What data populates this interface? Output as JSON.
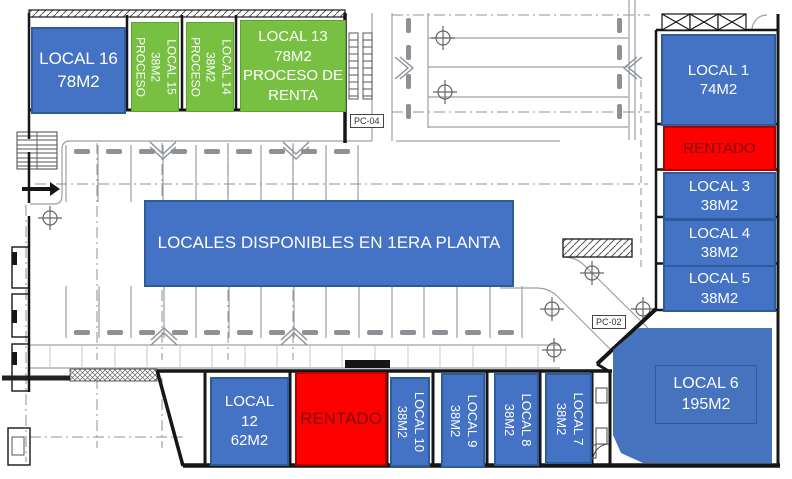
{
  "plan": {
    "banner": "LOCALES DISPONIBLES EN 1ERA PLANTA",
    "labels": {
      "pc04": "PC-04",
      "pc02": "PC-02"
    },
    "colors": {
      "available": "#4472C4",
      "in_process": "#77C042",
      "rented": "#FF0000",
      "rented_text": "#7A0C0C",
      "unit_text": "#FFFFFF",
      "border_blue": "#2E5B9C",
      "border_green": "#5FA433"
    },
    "units": {
      "local16": {
        "name": "LOCAL 16",
        "area": "78M2",
        "status": "available"
      },
      "local15": {
        "name": "LOCAL 15",
        "area": "38M2",
        "note": "PROCESO",
        "status": "in_process"
      },
      "local14": {
        "name": "LOCAL 14",
        "area": "38M2",
        "note": "PROCESO",
        "status": "in_process"
      },
      "local13": {
        "name": "LOCAL 13",
        "area": "78M2",
        "note1": "PROCESO DE",
        "note2": "RENTA",
        "status": "in_process"
      },
      "local1": {
        "name": "LOCAL 1",
        "area": "74M2",
        "status": "available"
      },
      "rentado_top": {
        "label": "RENTADO",
        "status": "rented"
      },
      "local3": {
        "name": "LOCAL 3",
        "area": "38M2",
        "status": "available"
      },
      "local4": {
        "name": "LOCAL 4",
        "area": "38M2",
        "status": "available"
      },
      "local5": {
        "name": "LOCAL 5",
        "area": "38M2",
        "status": "available"
      },
      "local6": {
        "name": "LOCAL 6",
        "area": "195M2",
        "status": "available"
      },
      "local12": {
        "name_line1": "LOCAL",
        "name_line2": "12",
        "area": "62M2",
        "status": "available"
      },
      "rentado_bottom": {
        "label": "RENTADO",
        "status": "rented"
      },
      "local10": {
        "name": "LOCAL 10",
        "area": "38M2",
        "status": "available"
      },
      "local9": {
        "name": "LOCAL 9",
        "area": "38M2",
        "status": "available"
      },
      "local8": {
        "name": "LOCAL 8",
        "area": "38M2",
        "status": "available"
      },
      "local7": {
        "name": "LOCAL 7",
        "area": "38M2",
        "status": "available"
      }
    }
  }
}
